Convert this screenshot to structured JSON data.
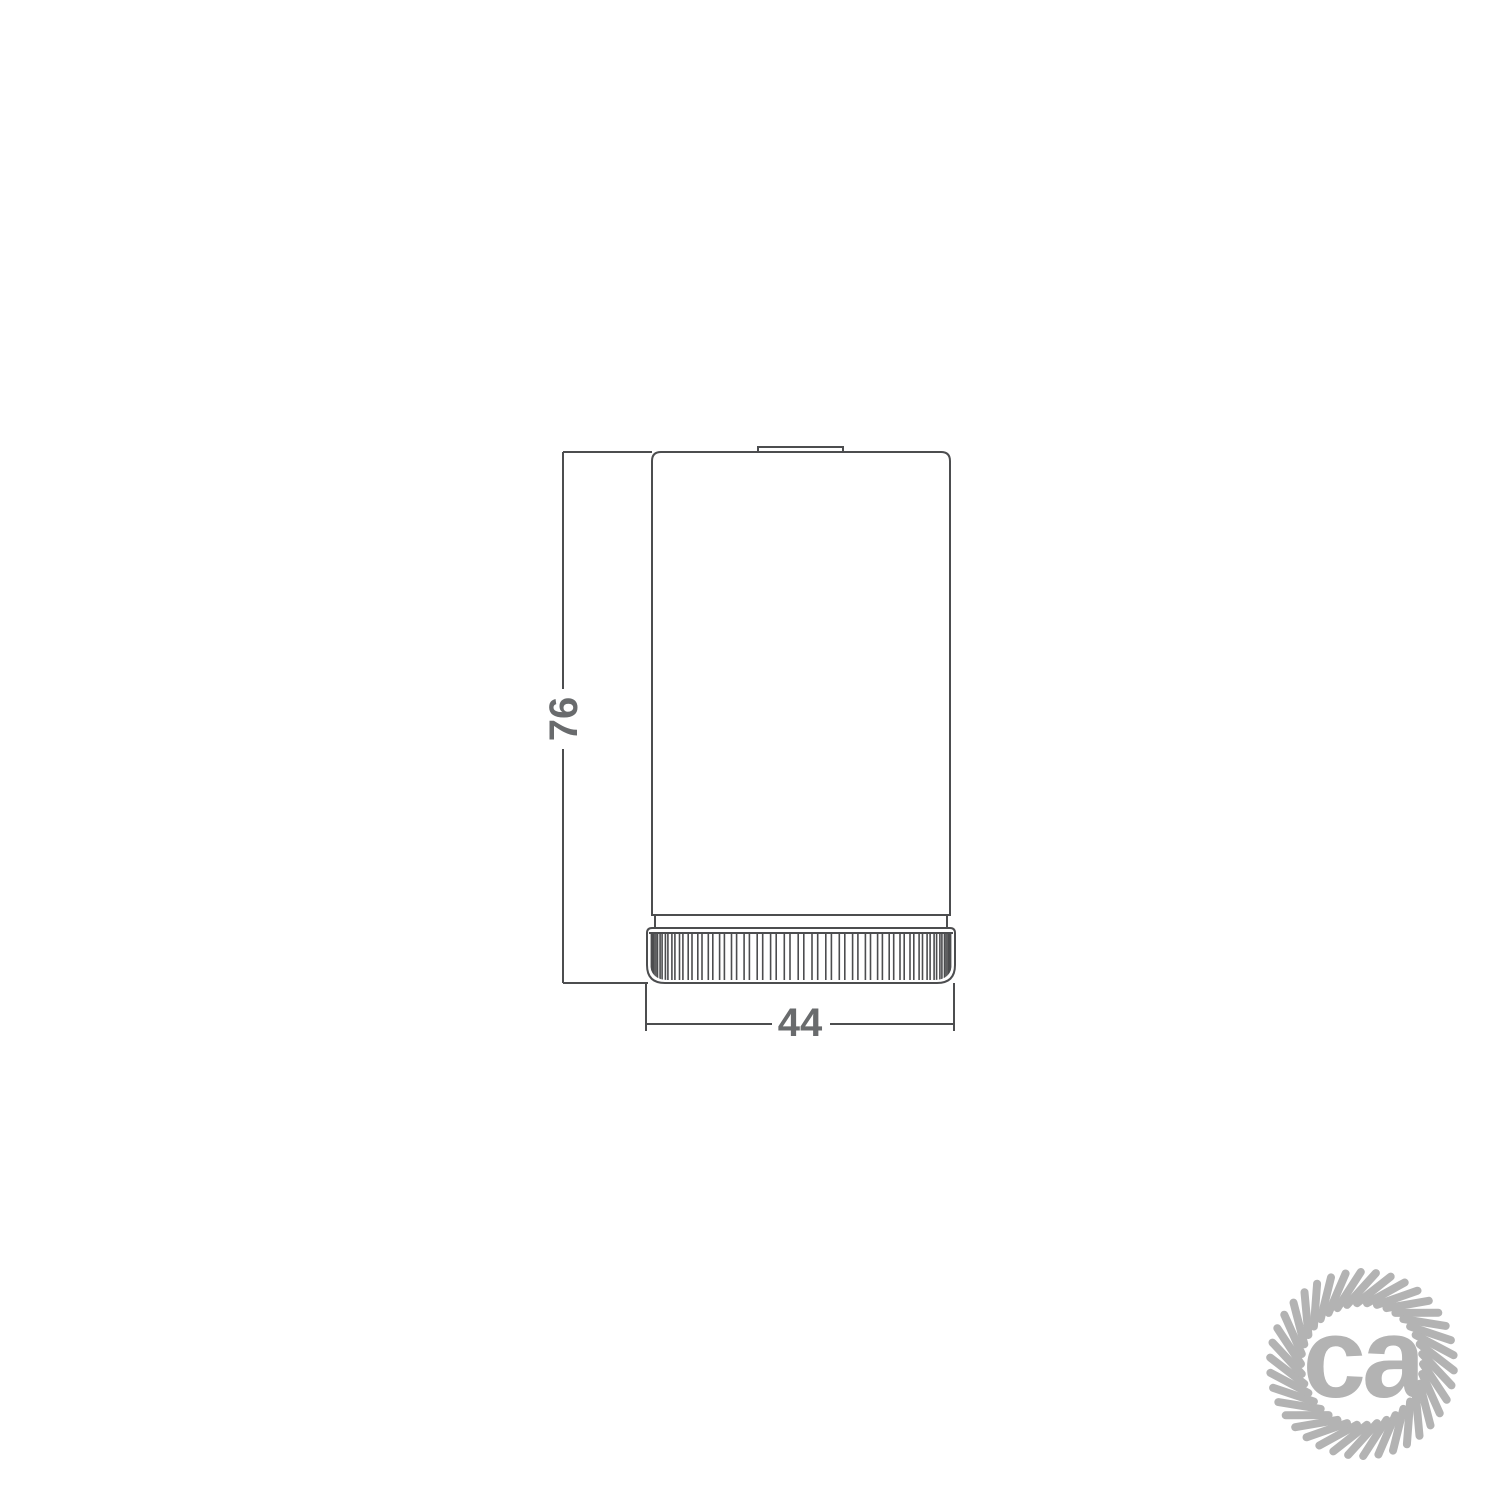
{
  "drawing": {
    "height_dimension_label": "76",
    "width_dimension_label": "44"
  },
  "logo": {
    "text": "ca"
  },
  "colors": {
    "background": "#ffffff",
    "line": "#4c4d4f",
    "dim_text": "#696b6d",
    "logo": "#b3b3b3"
  }
}
